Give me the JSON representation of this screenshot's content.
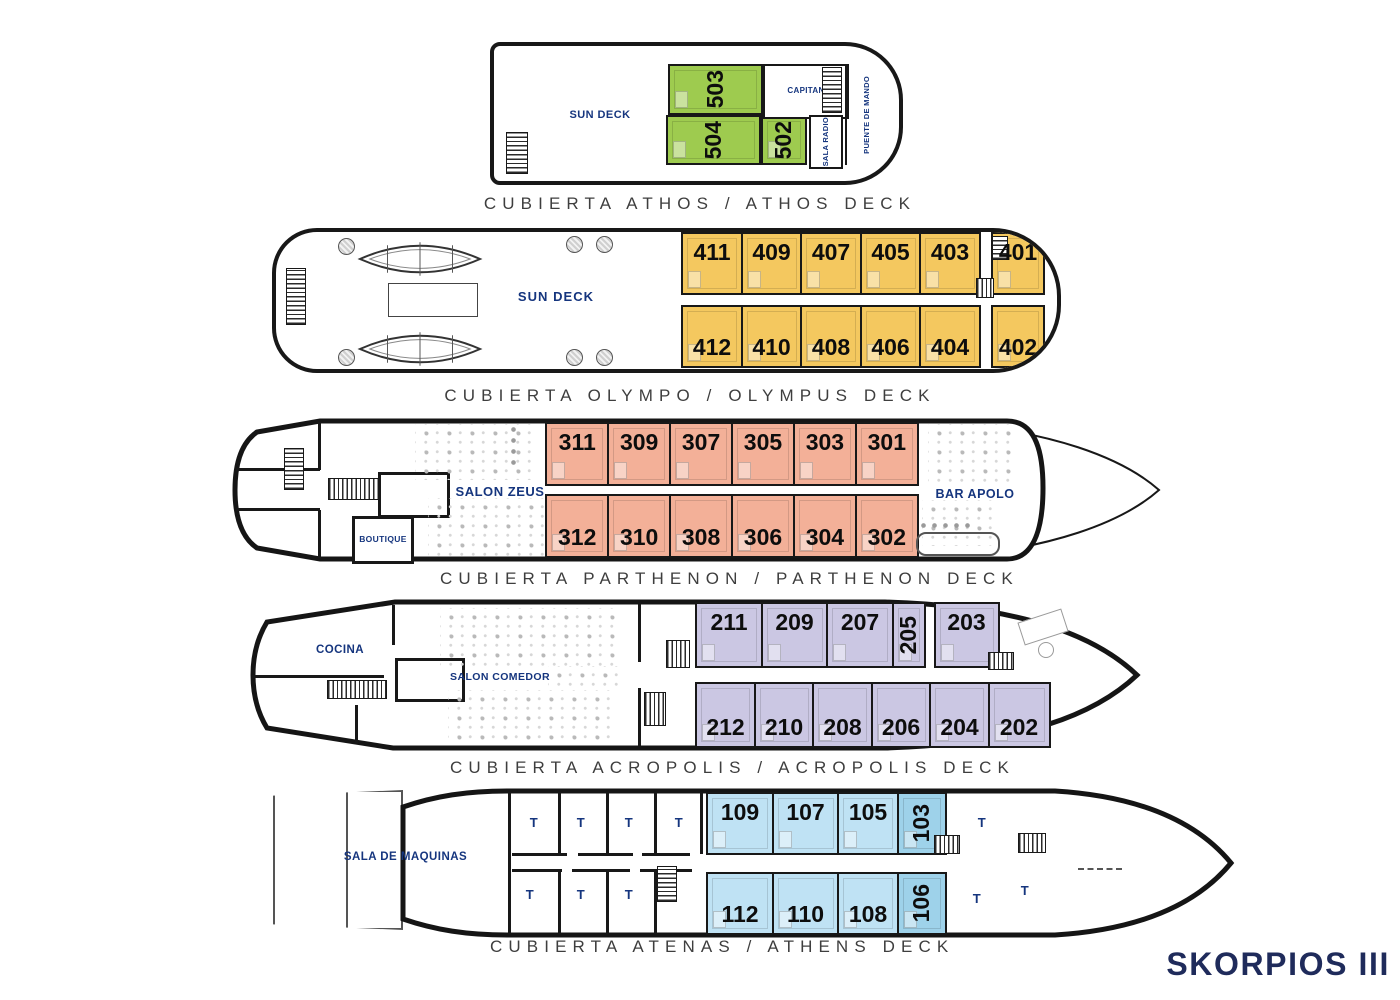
{
  "ship_name": "SKORPIOS III",
  "colors": {
    "athos_green": "#9ecb4f",
    "olympo_gold": "#f4c85f",
    "parthenon_salmon": "#f3b098",
    "acropolis_lavender": "#cbc7e3",
    "atenas_blue": "#bfe2f4",
    "atenas_blue_dark": "#9ed2ea",
    "label_navy": "#15357e",
    "title_gray": "#3e3e3e",
    "ship_name_navy": "#1f2b5b"
  },
  "decks": [
    {
      "id": "athos",
      "title": "CUBIERTA ATHOS / ATHOS DECK",
      "areas": {
        "sun_deck": "SUN DECK",
        "capitan": "CAPITAN",
        "sala_radio": "SALA RADIO",
        "puente_de_mando": "PUENTE DE MANDO"
      },
      "cabins": [
        "503",
        "504",
        "502"
      ]
    },
    {
      "id": "olympo",
      "title": "CUBIERTA OLYMPO / OLYMPUS DECK",
      "areas": {
        "sun_deck": "SUN DECK"
      },
      "cabins_top": [
        "411",
        "409",
        "407",
        "405",
        "403",
        "401"
      ],
      "cabins_bottom": [
        "412",
        "410",
        "408",
        "406",
        "404",
        "402"
      ]
    },
    {
      "id": "parthenon",
      "title": "CUBIERTA PARTHENON / PARTHENON DECK",
      "areas": {
        "salon_zeus": "SALON ZEUS",
        "boutique": "BOUTIQUE",
        "bar_apolo": "BAR APOLO"
      },
      "cabins_top": [
        "311",
        "309",
        "307",
        "305",
        "303",
        "301"
      ],
      "cabins_bottom": [
        "312",
        "310",
        "308",
        "306",
        "304",
        "302"
      ]
    },
    {
      "id": "acropolis",
      "title": "CUBIERTA ACROPOLIS / ACROPOLIS DECK",
      "areas": {
        "cocina": "COCINA",
        "salon_comedor": "SALON COMEDOR"
      },
      "cabins_top": [
        "211",
        "209",
        "207",
        "205",
        "203"
      ],
      "cabins_bottom": [
        "212",
        "210",
        "208",
        "206",
        "204",
        "202"
      ]
    },
    {
      "id": "atenas",
      "title": "CUBIERTA ATENAS / ATHENS DECK",
      "areas": {
        "sala_de_maquinas": "SALA DE MAQUINAS",
        "crew_cabin": "T"
      },
      "cabins_top": [
        "109",
        "107",
        "105",
        "103"
      ],
      "cabins_bottom": [
        "112",
        "110",
        "108",
        "106"
      ]
    }
  ]
}
